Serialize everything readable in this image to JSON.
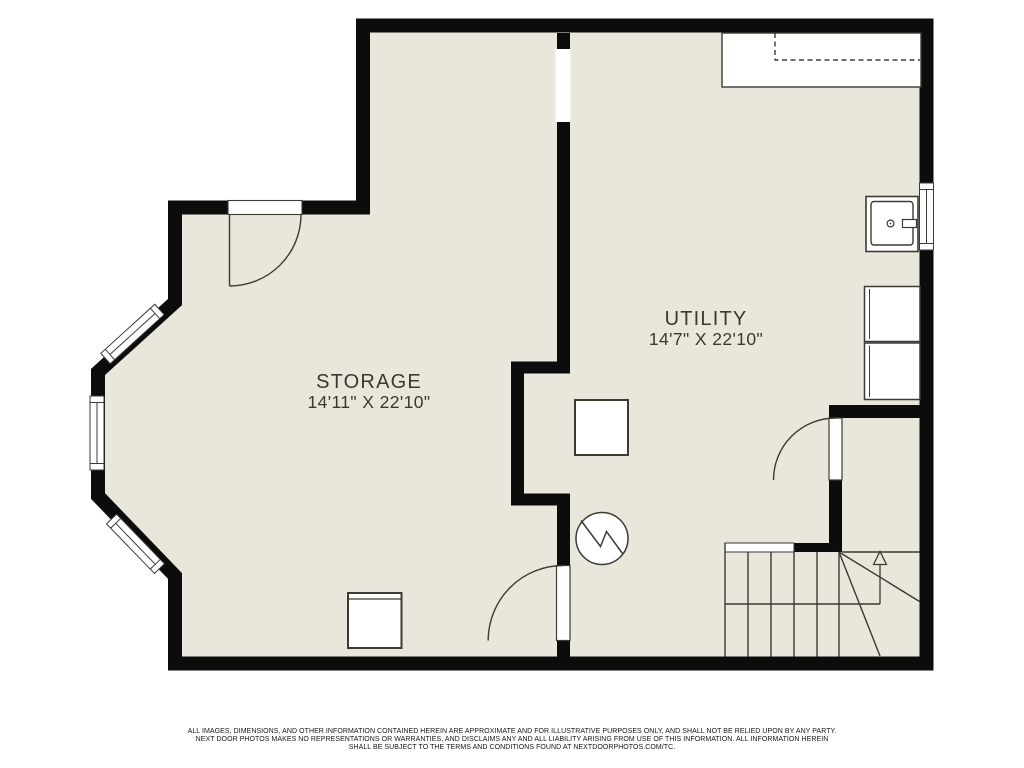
{
  "floorplan": {
    "colors": {
      "floor": "#e9e7dc",
      "wall": "#0c0c0c",
      "line": "#3b3a33",
      "background": "#ffffff",
      "text": "#3a3931"
    },
    "rooms": [
      {
        "name": "STORAGE",
        "dimensions": "14'11\" X 22'10\""
      },
      {
        "name": "UTILITY",
        "dimensions": "14'7\" X 22'10\""
      }
    ],
    "symbols": [
      "bay-window",
      "entry-door",
      "interior-door",
      "stair-door",
      "counter-shelf",
      "utility-sink",
      "washer",
      "dryer",
      "furnace-pad",
      "storage-cabinet",
      "sump-pump",
      "staircase-up-arrow"
    ]
  },
  "disclaimer": {
    "line1": "ALL IMAGES, DIMENSIONS, AND OTHER INFORMATION CONTAINED HEREIN ARE APPROXIMATE AND FOR ILLUSTRATIVE PURPOSES ONLY, AND SHALL NOT BE RELIED UPON BY ANY PARTY.",
    "line2": "NEXT DOOR PHOTOS MAKES NO REPRESENTATIONS OR WARRANTIES, AND DISCLAIMS ANY AND ALL LIABILITY ARISING FROM USE OF THIS INFORMATION. ALL INFORMATION HEREIN",
    "line3": "SHALL BE SUBJECT TO THE TERMS AND CONDITIONS FOUND AT NEXTDOORPHOTOS.COM/TC."
  }
}
